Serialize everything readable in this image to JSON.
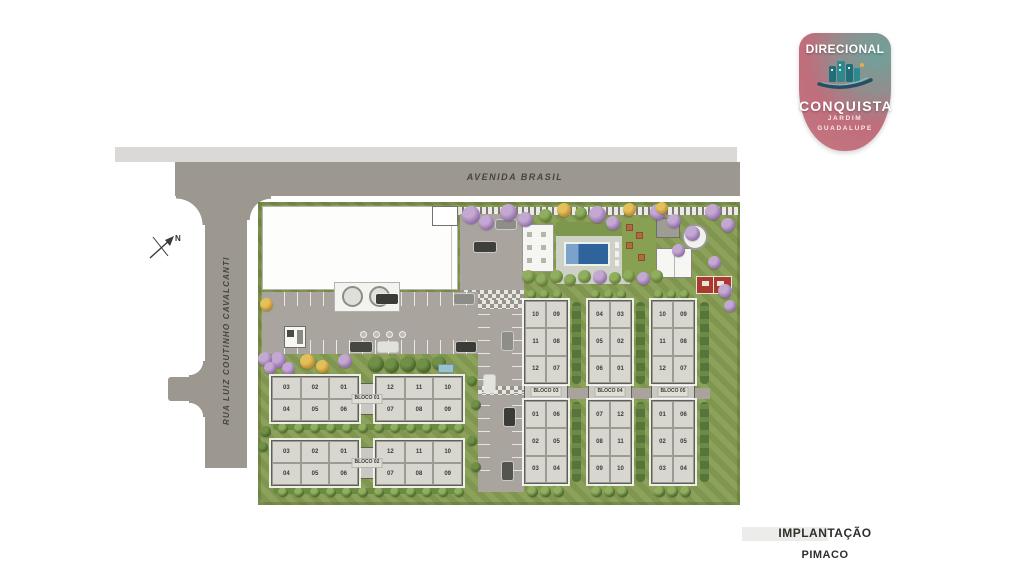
{
  "logo": {
    "brand": "DIRECIONAL",
    "project": "CONQUISTA",
    "location_line1": "JARDIM",
    "location_line2": "GUADALUPE"
  },
  "streets": {
    "top": "AVENIDA BRASIL",
    "left": "RUA LUIZ COUTINHO CAVALCANTI"
  },
  "compass": {
    "label": "N"
  },
  "caption": {
    "title": "IMPLANTAÇÃO",
    "subtitle": "PIMACO"
  },
  "site": {
    "horizontal_blocks": [
      {
        "label": "BLOCO 01",
        "left_wing": {
          "top": [
            "03",
            "02",
            "01"
          ],
          "bottom": [
            "04",
            "05",
            "06"
          ]
        },
        "right_wing": {
          "top": [
            "12",
            "11",
            "10"
          ],
          "bottom": [
            "07",
            "08",
            "09"
          ]
        }
      },
      {
        "label": "BLOCO 02",
        "left_wing": {
          "top": [
            "03",
            "02",
            "01"
          ],
          "bottom": [
            "04",
            "05",
            "06"
          ]
        },
        "right_wing": {
          "top": [
            "12",
            "11",
            "10"
          ],
          "bottom": [
            "07",
            "08",
            "09"
          ]
        }
      }
    ],
    "vertical_blocks": [
      {
        "label": "BLOCO 03",
        "top_wing": [
          [
            "10",
            "09"
          ],
          [
            "11",
            "08"
          ],
          [
            "12",
            "07"
          ]
        ],
        "bottom_wing": [
          [
            "01",
            "06"
          ],
          [
            "02",
            "05"
          ],
          [
            "03",
            "04"
          ]
        ]
      },
      {
        "label": "BLOCO 04",
        "top_wing": [
          [
            "04",
            "03"
          ],
          [
            "05",
            "02"
          ],
          [
            "06",
            "01"
          ]
        ],
        "bottom_wing": [
          [
            "07",
            "12"
          ],
          [
            "08",
            "11"
          ],
          [
            "09",
            "10"
          ]
        ]
      },
      {
        "label": "BLOCO 05",
        "top_wing": [
          [
            "10",
            "09"
          ],
          [
            "11",
            "08"
          ],
          [
            "12",
            "07"
          ]
        ],
        "bottom_wing": [
          [
            "01",
            "06"
          ],
          [
            "02",
            "05"
          ],
          [
            "03",
            "04"
          ]
        ]
      }
    ]
  },
  "colors": {
    "street": "#9c978f",
    "sidewalk": "#dbd9d5",
    "grass": "#879d53",
    "road": "#a9a59e",
    "building_fill": "#d7d7d0",
    "pool": "#2f639b",
    "court": "#a83a2e",
    "logo_pink": "#c46b7c",
    "logo_teal": "#6ea29a"
  }
}
